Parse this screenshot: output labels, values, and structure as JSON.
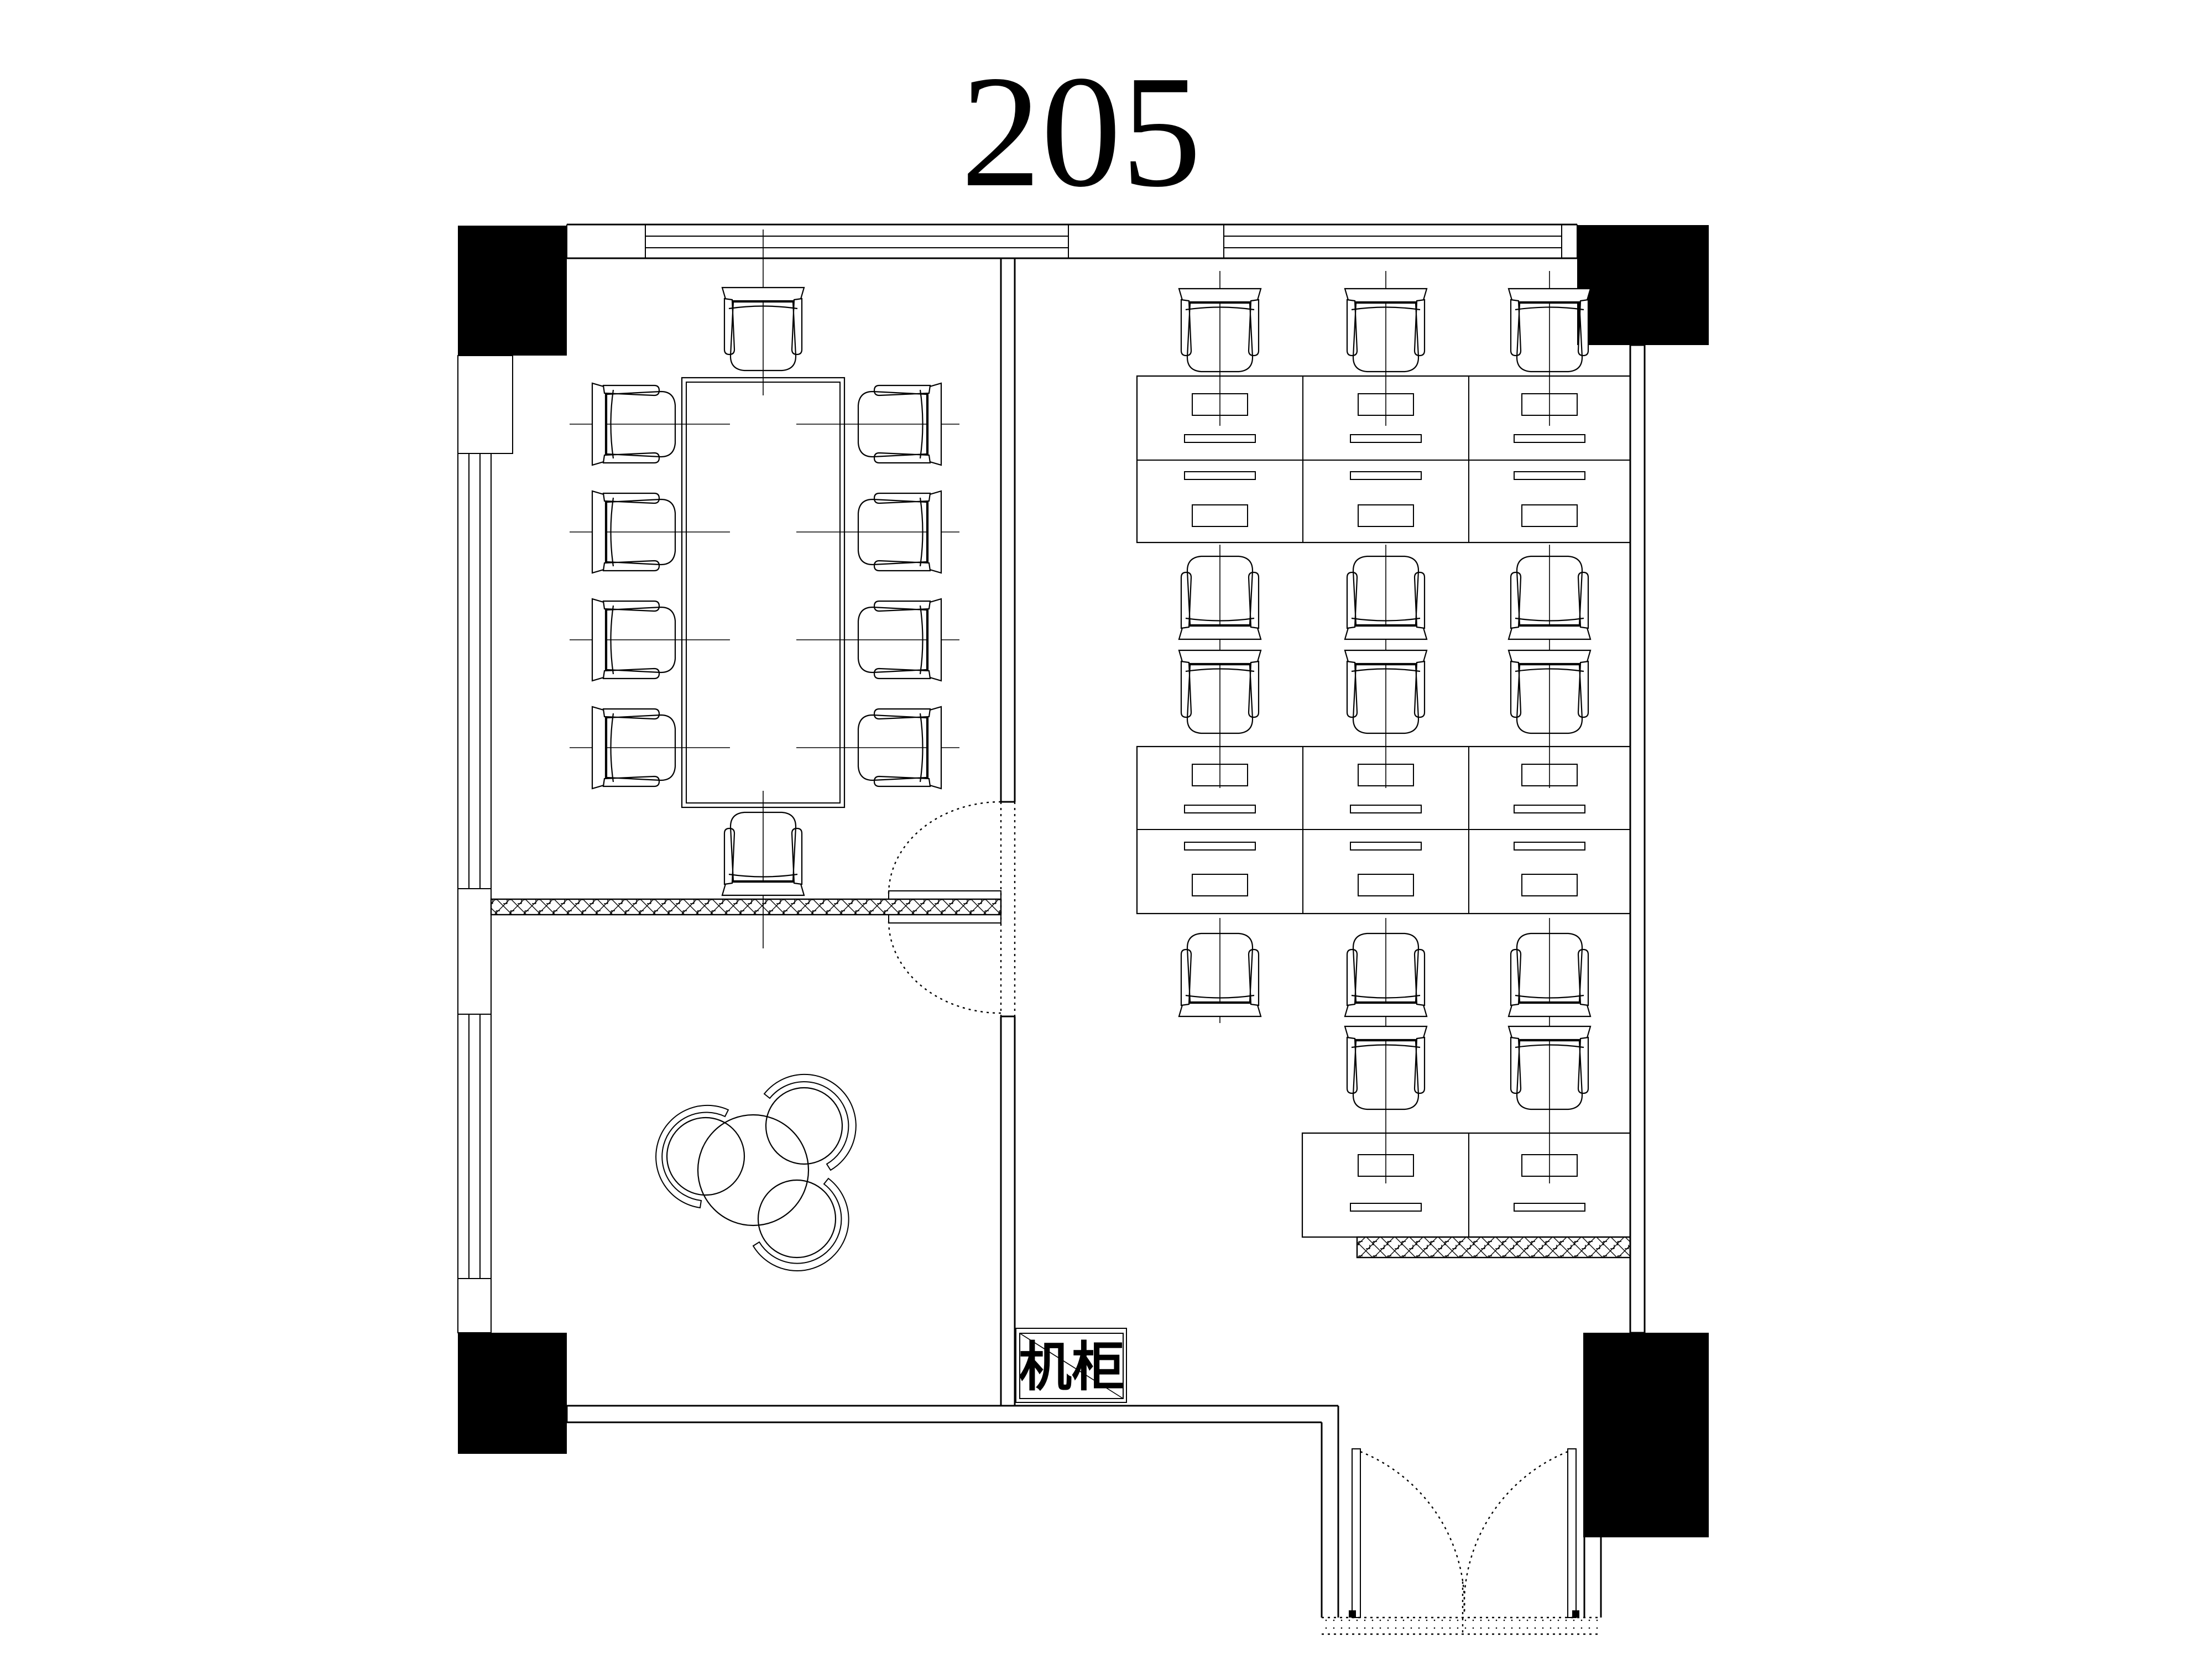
{
  "title": "205",
  "labels": {
    "cabinet": "机柜"
  },
  "colors": {
    "line": "#000000",
    "background": "#ffffff",
    "column_fill": "#000000"
  }
}
